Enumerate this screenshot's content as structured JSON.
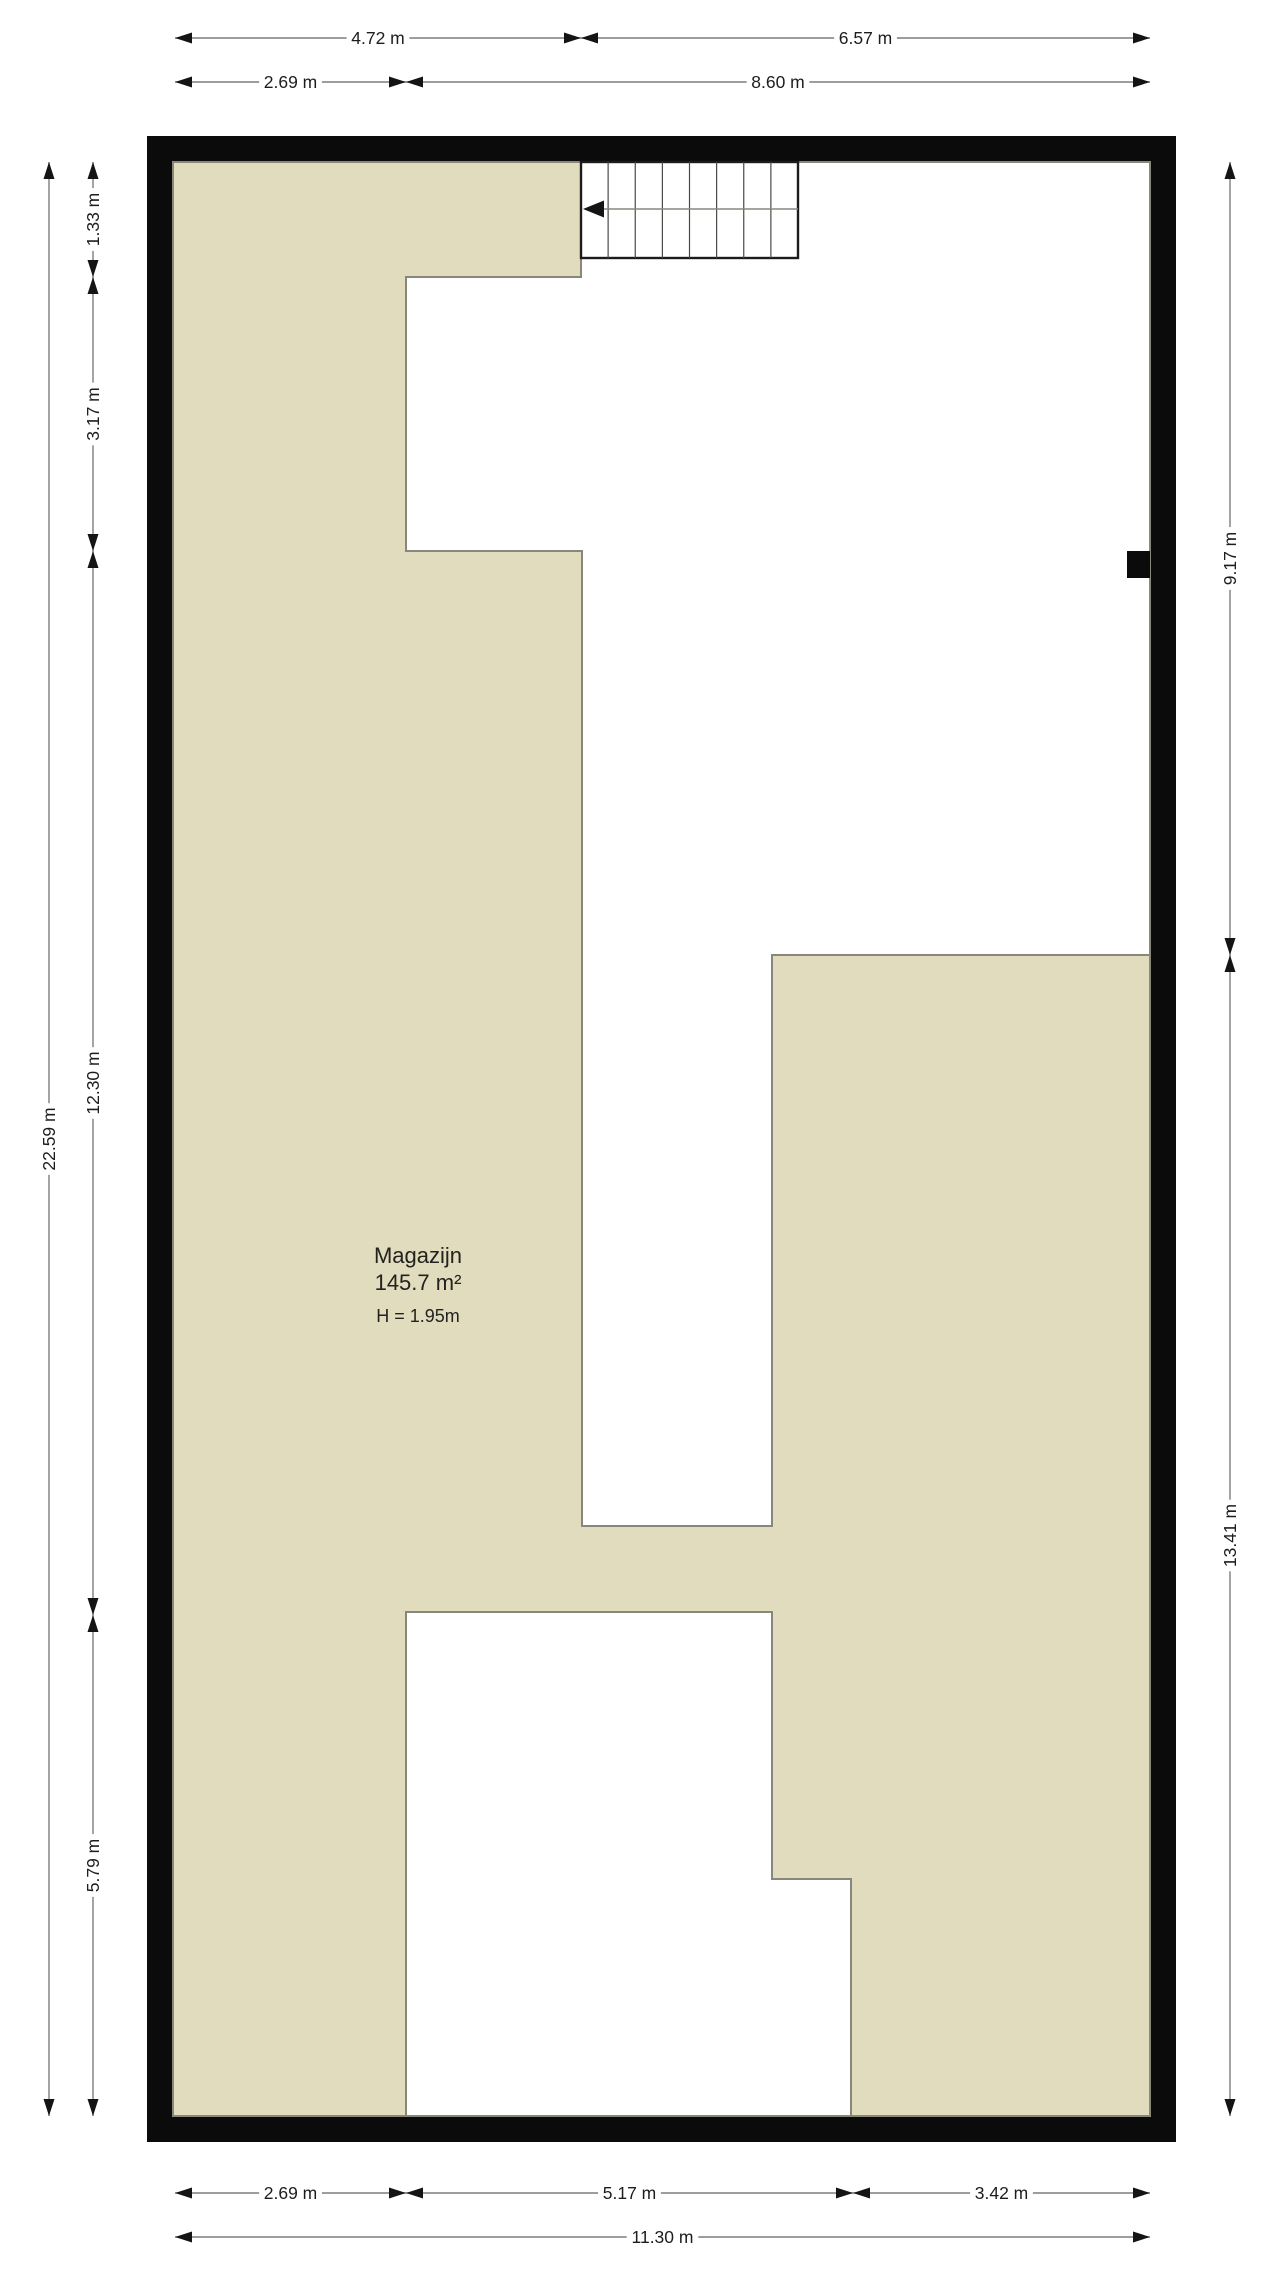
{
  "room": {
    "name": "Magazijn",
    "area": "145.7 m²",
    "height": "H = 1.95m"
  },
  "colors": {
    "floor": "#e2dcbe",
    "outline": "#87877b",
    "wall": "#0b0b0b",
    "dim_line": "#7d7d7d",
    "walkline": "#888880",
    "tread_line": "#4a4a44",
    "arrow": "#141414",
    "text": "#1d1d1b",
    "white": "#ffffff"
  },
  "geometry": {
    "outer_wall": {
      "x1": 147,
      "y1": 136,
      "x2": 1176,
      "y2": 2142
    },
    "inner_floor": {
      "x1": 173,
      "y1": 162,
      "x2": 1150,
      "y2": 2116
    },
    "white_region_top": "798,162 1150,162 1150,955 772,955 772,1526 582,1526 582,551 406,551 406,277 581,277 581,258 798,258",
    "white_region_bottom": "406,1612 772,1612 772,1879 851,1879 851,2116 406,2116",
    "stair": {
      "x1": 581,
      "y1": 162,
      "x2": 798,
      "y2": 258,
      "treads": 8,
      "walk_y": 209
    },
    "wall_stub": {
      "x1": 1127,
      "y1": 551,
      "x2": 1150,
      "y2": 578
    }
  },
  "room_label_anchor": {
    "x": 418,
    "name_y": 1243,
    "area_y": 1270,
    "height_y": 1306
  },
  "dimensions": [
    {
      "orient": "h",
      "y": 38,
      "segments": [
        {
          "from": 175,
          "to": 581,
          "label": "4.72 m"
        },
        {
          "from": 581,
          "to": 1150,
          "label": "6.57 m"
        }
      ]
    },
    {
      "orient": "h",
      "y": 82,
      "segments": [
        {
          "from": 175,
          "to": 406,
          "label": "2.69 m"
        },
        {
          "from": 406,
          "to": 1150,
          "label": "8.60 m"
        }
      ]
    },
    {
      "orient": "h",
      "y": 2193,
      "segments": [
        {
          "from": 175,
          "to": 406,
          "label": "2.69 m"
        },
        {
          "from": 406,
          "to": 853,
          "label": "5.17 m"
        },
        {
          "from": 853,
          "to": 1150,
          "label": "3.42 m"
        }
      ]
    },
    {
      "orient": "h",
      "y": 2237,
      "segments": [
        {
          "from": 175,
          "to": 1150,
          "label": "11.30 m"
        }
      ]
    },
    {
      "orient": "v",
      "x": 49,
      "segments": [
        {
          "from": 162,
          "to": 2116,
          "label": "22.59 m"
        }
      ]
    },
    {
      "orient": "v",
      "x": 93,
      "segments": [
        {
          "from": 162,
          "to": 277,
          "label": "1.33 m"
        },
        {
          "from": 277,
          "to": 551,
          "label": "3.17 m"
        },
        {
          "from": 551,
          "to": 1615,
          "label": "12.30 m"
        },
        {
          "from": 1615,
          "to": 2116,
          "label": "5.79 m"
        }
      ]
    },
    {
      "orient": "v",
      "x": 1230,
      "segments": [
        {
          "from": 162,
          "to": 955,
          "label": "9.17 m"
        },
        {
          "from": 955,
          "to": 2116,
          "label": "13.41 m"
        }
      ]
    }
  ]
}
